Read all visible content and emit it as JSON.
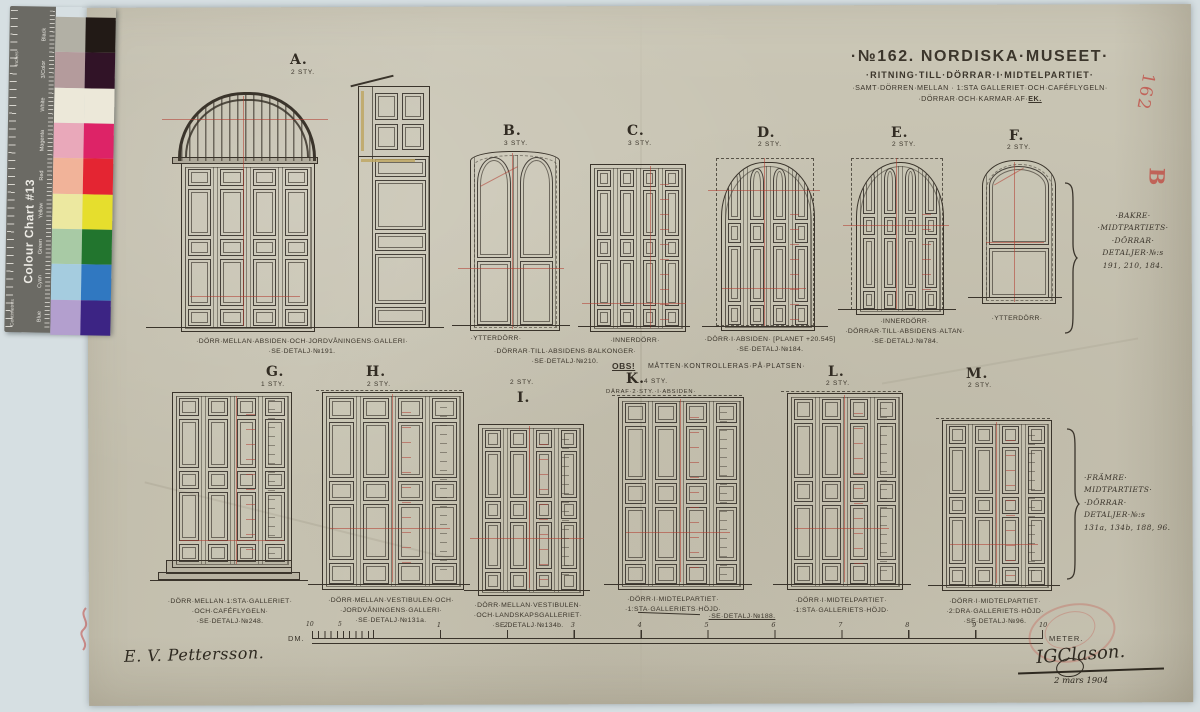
{
  "colour_chart": {
    "title": "Colour Chart #13",
    "edge_top_label": "Inches",
    "edge_bottom_label": "Centimetres",
    "rows": [
      {
        "label": "Black",
        "light": "#b2b0a5",
        "full": "#221a16"
      },
      {
        "label": "3/Color",
        "light": "#b49b9c",
        "full": "#311327"
      },
      {
        "label": "White",
        "light": "#ece8d9",
        "full": "#ece8d9"
      },
      {
        "label": "Magenta",
        "light": "#e9a8ba",
        "full": "#dd2367"
      },
      {
        "label": "Red",
        "light": "#f1b399",
        "full": "#e42532"
      },
      {
        "label": "Yellow",
        "light": "#ece8a0",
        "full": "#e6de2d"
      },
      {
        "label": "Green",
        "light": "#a8caa5",
        "full": "#22752e"
      },
      {
        "label": "Cyan",
        "light": "#a5ccdf",
        "full": "#3078c1"
      },
      {
        "label": "Blue",
        "light": "#b39fce",
        "full": "#3c2484"
      }
    ]
  },
  "title_block": {
    "line1": "·№162. NORDISKA·MUSEET·",
    "line2": "·RITNING·TILL·DÖRRAR·I·MIDTELPARTIET·",
    "line3": "·SAMT·DÖRREN·MELLAN · 1:STA GALLERIET·OCH·CAFÉFLYGELN·",
    "line4_prefix": "·DÖRRAR·OCH·KARMAR·AF·",
    "line4_material": "EK."
  },
  "doors": {
    "A": {
      "letter": "A.",
      "count": "2 STY.",
      "caption": [
        "·DÖRR·MELLAN·ABSIDEN·OCH·JORDVÅNINGENS·GALLERI·",
        "·SE·DETALJ·№191."
      ]
    },
    "B": {
      "letter": "B.",
      "count": "3 STY.",
      "caption": [
        "·YTTERDÖRR·"
      ]
    },
    "C": {
      "letter": "C.",
      "count": "3 STY.",
      "caption": [
        "·INNERDÖRR·"
      ]
    },
    "BC": {
      "caption": [
        "·DÖRRAR·TILL·ABSIDENS·BALKONGER·",
        "·SE·DETALJ·№210."
      ]
    },
    "D": {
      "letter": "D.",
      "count": "2 STY.",
      "caption": [
        "·DÖRR·I·ABSIDEN· [PLANET +20.545]",
        "·SE·DETALJ·№184."
      ]
    },
    "E": {
      "letter": "E.",
      "count": "2 STY.",
      "caption": [
        "·INNERDÖRR·",
        "·DÖRRAR·TILL·ABSIDENS·ALTAN·",
        "·SE·DETALJ·№784."
      ]
    },
    "F": {
      "letter": "F.",
      "count": "2 STY.",
      "caption": [
        "·YTTERDÖRR·"
      ]
    },
    "G": {
      "letter": "G.",
      "count": "1 STY.",
      "caption": [
        "·DÖRR·MELLAN·1:STA·GALLERIET·",
        "·OCH·CAFÉFLYGELN·",
        "·SE·DETALJ·№248."
      ]
    },
    "H": {
      "letter": "H.",
      "count": "2 STY.",
      "caption": [
        "·DÖRR·MELLAN·VESTIBULEN·OCH·",
        "·JORDVÅNINGENS·GALLERI·",
        "·SE·DETALJ·№131a."
      ]
    },
    "I": {
      "letter": "I.",
      "count": "2 STY.",
      "caption": [
        "·DÖRR·MELLAN·VESTIBULEN·",
        "·OCH·LANDSKAPSGALLERIET·",
        "·SE·DETALJ·№134b."
      ]
    },
    "K": {
      "letter": "K.",
      "count": "4 STY.",
      "extra": "DÄRAF·2·STY.·I·ABSIDEN·",
      "caption": [
        "·DÖRR·I·MIDTELPARTIET·",
        "·1:STA·GALLERIETS·HÖJD·"
      ]
    },
    "KL": {
      "caption": [
        "·SE·DETALJ·№188."
      ]
    },
    "L": {
      "letter": "L.",
      "count": "2 STY.",
      "caption": [
        "·DÖRR·I·MIDTELPARTIET·",
        "·1:STA·GALLERIETS·HÖJD·"
      ]
    },
    "M": {
      "letter": "M.",
      "count": "2 STY.",
      "caption": [
        "·DÖRR·I·MIDTELPARTIET·",
        "·2:DRA·GALLERIETS·HÖJD·",
        "·SE·DETALJ·№96."
      ]
    }
  },
  "notes": {
    "obs_bold": "OBS!",
    "obs_text": "MÅTTEN·KONTROLLERAS·PÅ·PLATSEN·",
    "bracket_top": [
      "·BAKRE·",
      "·MIDTPARTIETS·",
      "·DÖRRAR·",
      "DETALJER·№:s",
      "191, 210, 184."
    ],
    "bracket_bottom": [
      "·FRÄMRE·",
      "MIDTPARTIETS·",
      "·DÖRRAR·",
      "DETALJER·№:s",
      "131a, 134b, 188, 96."
    ]
  },
  "scale_bar": {
    "dm_label": "DM.",
    "meter_label": "METER.",
    "sub_ticks": [
      "10",
      "5"
    ],
    "meters": [
      "1",
      "2",
      "3",
      "4",
      "5",
      "6",
      "7",
      "8",
      "9",
      "10"
    ]
  },
  "signatures": {
    "draughtsman": "E. V. Pettersson.",
    "architect": "IGClason.",
    "date": "2 mars 1904"
  },
  "red_marks": {
    "number": "162",
    "letter": "B"
  }
}
